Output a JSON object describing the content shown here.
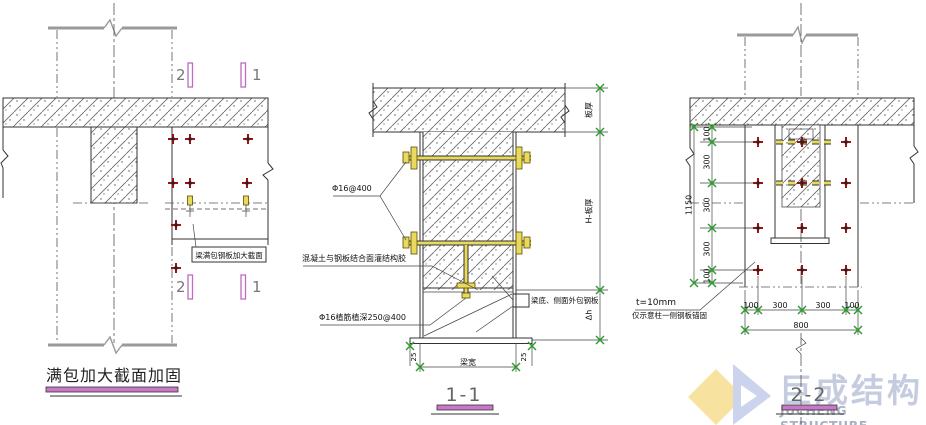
{
  "drawing": {
    "left_view": {
      "title": "满包加大截面加固",
      "note": "梁满包钢板加大截面",
      "section_marker_2": "2",
      "section_marker_1": "1"
    },
    "section_1_1": {
      "title": "1-1",
      "labels": {
        "bolts": "Φ16@400",
        "adhesive": "混凝土与钢板结合面灌结构胶",
        "anchor_rebar": "Φ16植筋植深250@400",
        "wrap_plate": "梁底、侧面外包钢板"
      },
      "dims": {
        "slab_thickness": "板厚",
        "beam_height": "H-板厚",
        "added_height": "Δh",
        "beam_width": "梁宽",
        "plate_offset_left": "25",
        "plate_offset_right": "25"
      }
    },
    "section_2_2": {
      "title": "2-2",
      "labels": {
        "plate_thickness": "t=10mm",
        "note": "仅示意柱一侧钢板锚固"
      },
      "dims_left": [
        "100",
        "300",
        "300",
        "300",
        "100"
      ],
      "dims_left_total": "1150",
      "dims_bottom": [
        "100",
        "300",
        "300",
        "100"
      ],
      "dims_bottom_total": "800"
    },
    "logo": {
      "name_cn": "巨成结构",
      "name_en": "JUCHENG STRUCTURE"
    },
    "colors": {
      "accent_magenta": "#c06ac0",
      "bolt_yellow": "#e9d95c",
      "marker_red": "#991111",
      "tick_green": "#2a9d2a"
    }
  }
}
